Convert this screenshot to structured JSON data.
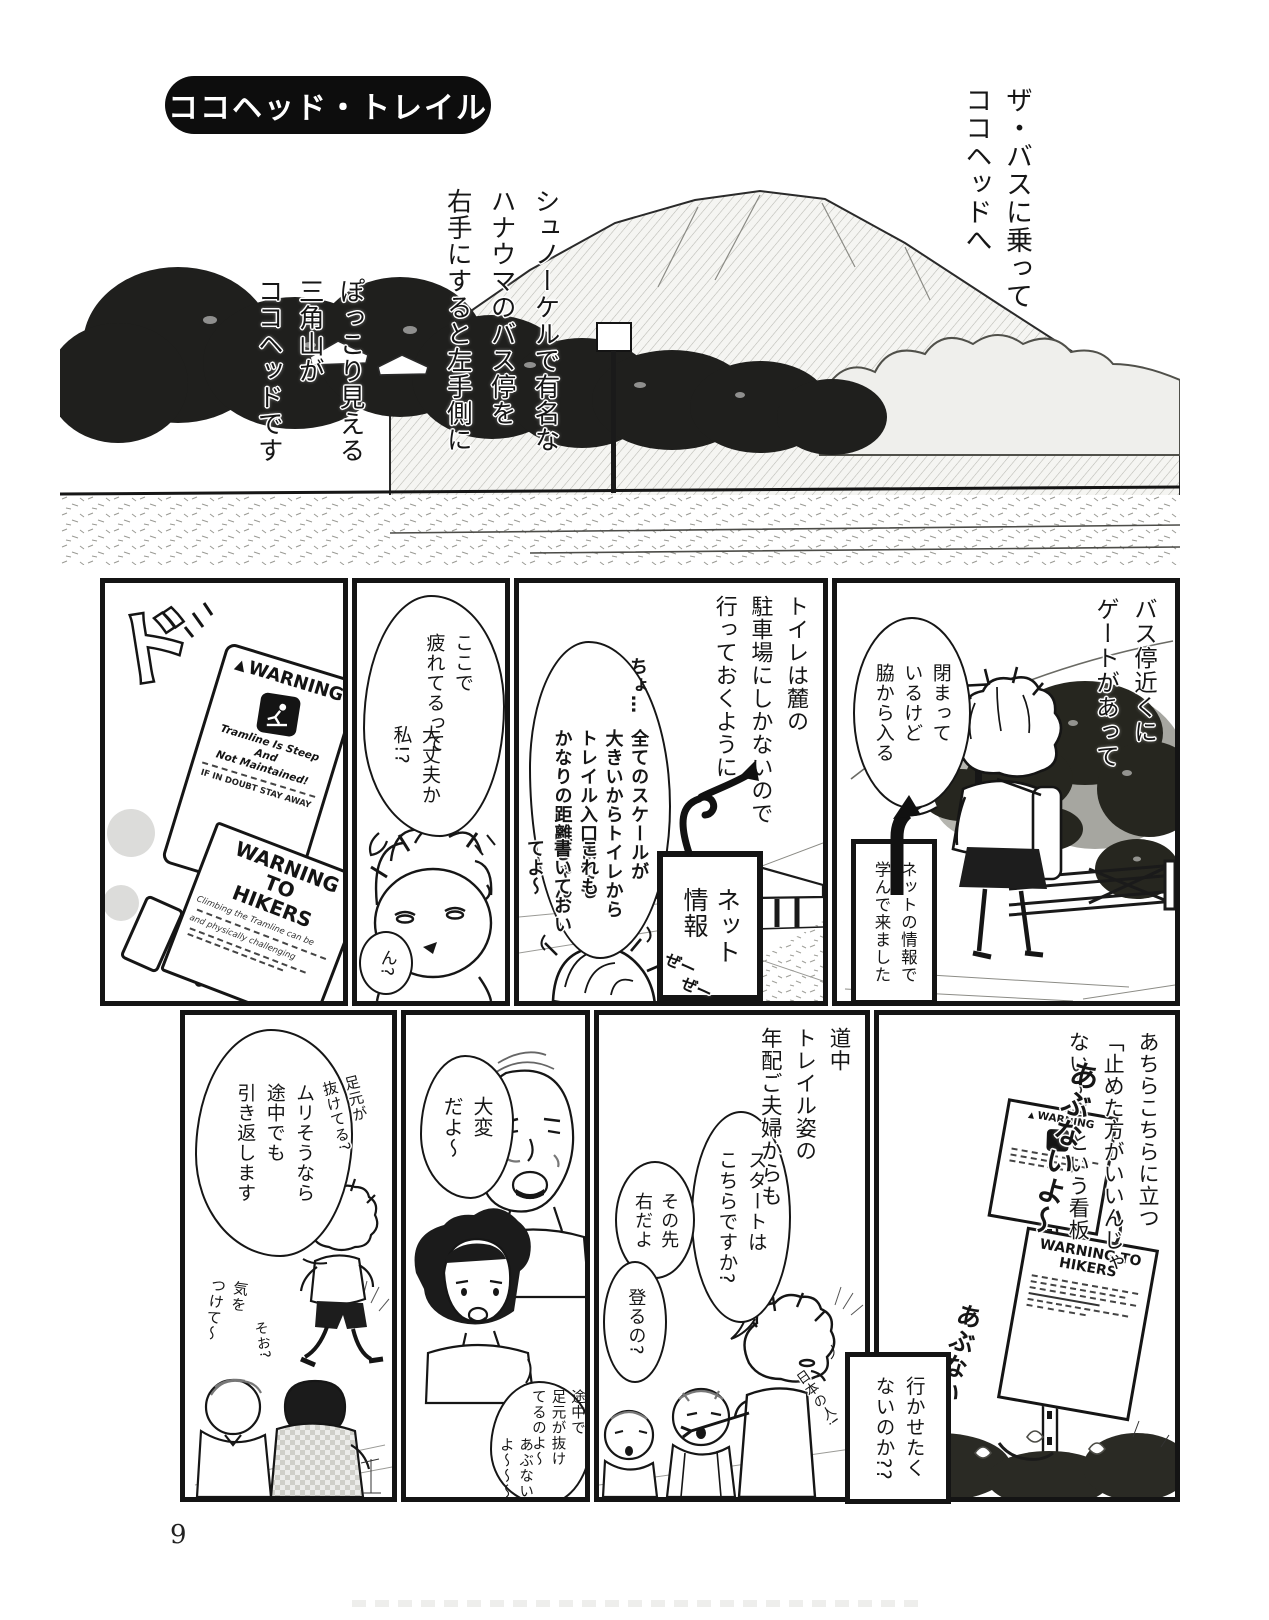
{
  "colors": {
    "ink": "#141414",
    "paper": "#ffffff"
  },
  "icons": {
    "warning_triangle": "▲"
  },
  "page": {
    "number": "9"
  },
  "header": {
    "title": "ココヘッド・トレイル"
  },
  "intro": {
    "narr_bus": "ザ・バスに乗って\nココヘッドへ",
    "narr_hanauma": "シュノーケルで有名な\nハナウマのバス停を\n右手にすると左手側に",
    "narr_kokohead": "ぽっこり見える\n三角山が\nココヘッドです"
  },
  "panels": {
    "gate": {
      "narration": "バス停近くに\nゲートがあって",
      "bubble": "閉まって\nいるけど\n脇から入る",
      "caption": "ネットの情報で\n学んで来ました"
    },
    "toilet": {
      "narration": "トイレは麓の\n駐車場にしかないので\n行っておくように",
      "bubble_cho": "ちょ…",
      "bubble_scale": "全てのスケールが\n大きいからトイレから\nトレイル入口までも\nかなりの距離じゃん",
      "net_label": "ネット\n情報",
      "bubble_koremo": "これも\n書いておい\nてよ〜",
      "sfx_pant1": "ぜー",
      "sfx_pant2": "ぜー"
    },
    "tired": {
      "bubble_main": "ここで\n疲れてるって",
      "bubble_sub": "大丈夫か\n私!?",
      "bubble_hm": "ん?"
    },
    "warning": {
      "sfx": "ド",
      "sign1_header": "WARNING",
      "sign1_line1": "Tramline Is Steep And",
      "sign1_line2": "Not Maintained!",
      "sign1_line3": "IF IN DOUBT STAY AWAY",
      "sign2_header": "WARNING TO\nHIKERS",
      "sign2_frag1": "Climbing the Tramline can be",
      "sign2_frag2": "and physically challenging"
    },
    "signs_everywhere": {
      "narration": "あちらこちらに立つ\n「止めた方がいいんじゃ\nない〜?」という看板",
      "hand_abunai1": "あぶないよ〜",
      "hand_abunai2": "あぶないよ",
      "caption": "行かせたく\nないのか??",
      "post_top_header": "WARNING",
      "post_bottom_header": "WARNING TO\nHIKERS"
    },
    "start": {
      "narration": "道中\nトレイル姿の\n年配ご夫婦からも",
      "bubble_q": "スタートは\nこちらですか?",
      "bubble_a": "その先\n右だよ",
      "bubble_q2": "登るの?",
      "hand_note": "日本の人!"
    },
    "taihen": {
      "bubble_taihen": "大変\nだよ〜",
      "bubble_nukete": "途中で\n足元が抜け\nてるのよ〜",
      "bubble_abunai": "あぶない\nよ〜〜〜"
    },
    "turnback": {
      "bubble": "ムリそうなら\n途中でも\n引き返します",
      "hand_ashimoto": "足元が\n抜けてる?",
      "hand_kiotsukete": "気を\nつけて〜",
      "hand_soo": "そお?"
    }
  }
}
